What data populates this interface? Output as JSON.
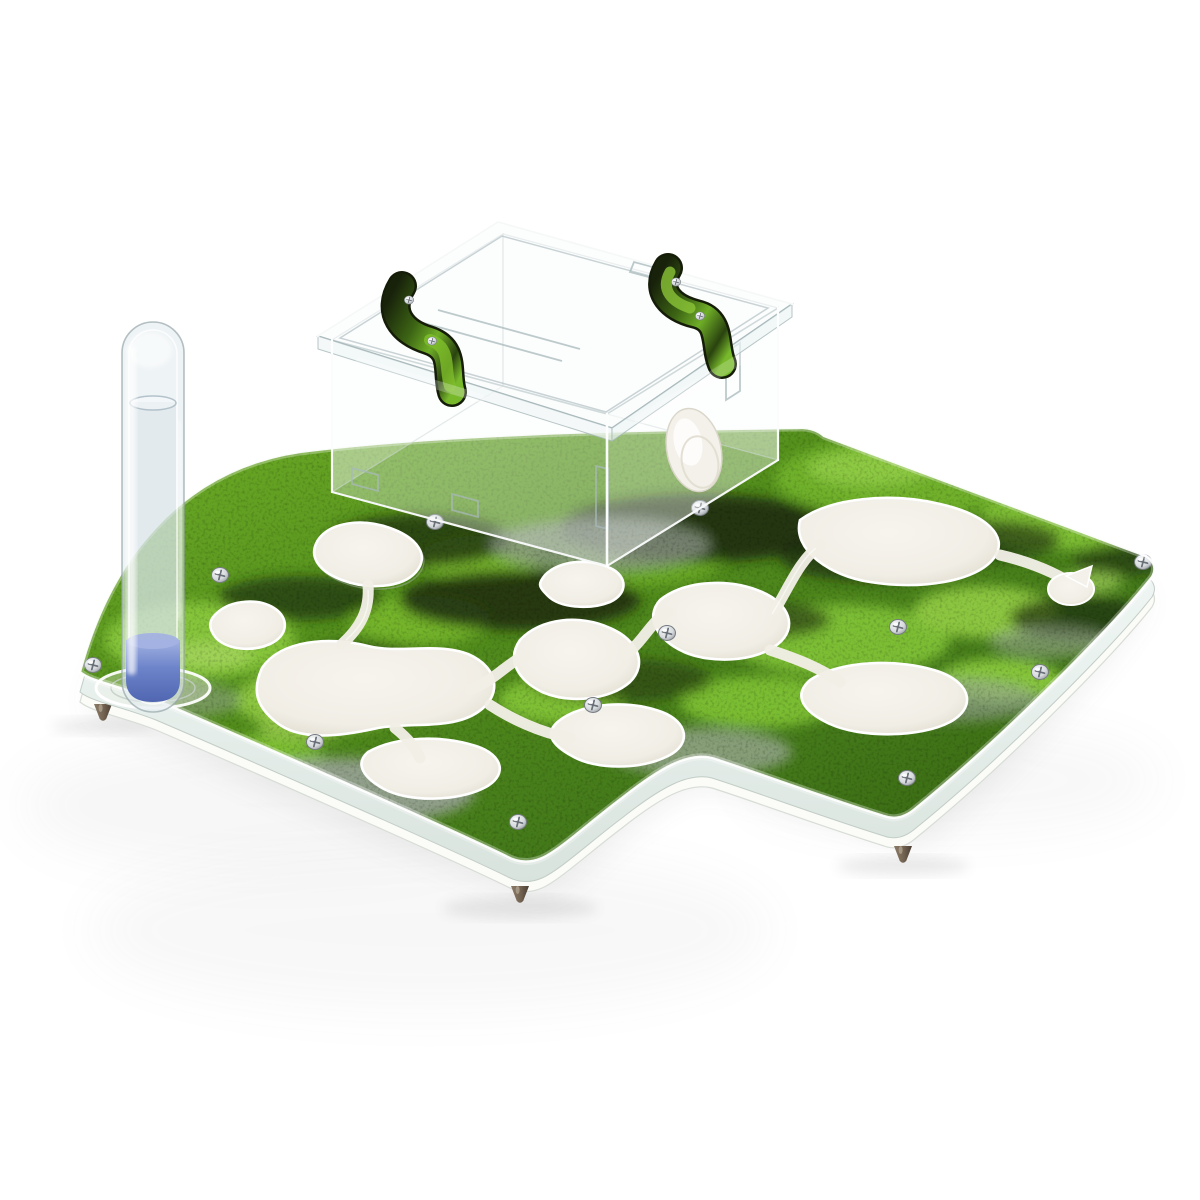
{
  "image": {
    "type": "product-photo",
    "subject": "Clear acrylic ant farm formicarium with green moss print, test tube and outworld box",
    "background": "white seamless studio backdrop"
  },
  "scene": {
    "parts": [
      "layered acrylic base plate with wavy front edge",
      "green moss-print top layer with organic nest-chamber cutouts",
      "white sandwich bottom layer",
      "phillips screws fastening the layers",
      "metal cone feet",
      "vertical glass test tube with water and blue cotton plug seated in a round port",
      "transparent acrylic outworld box with lid",
      "two moss-print lid clips",
      "white round feeding-port plug on box side",
      "round nest entrance hole with pointer notch"
    ],
    "counts": {
      "screws": 12,
      "nest_chambers": 10,
      "tunnel_channels": 8,
      "lid_clips": 2,
      "feet": 3,
      "test_tubes": 1
    }
  },
  "colors": {
    "bg": "#ffffff",
    "moss-light": "#8cc63f",
    "moss-mid": "#55911d",
    "moss-dark": "#2c4013",
    "stone-gray": "#9aa49a",
    "chamber-white": "#f1eee6",
    "chamber-shade": "#dcd7c8",
    "acrylic-edge": "#ffffff",
    "acrylic-tint": "#eaf2ef",
    "acrylic-line": "#a7b8ba",
    "tube-blue": "#6d84ca",
    "tube-blue-light": "#a3b2e2",
    "screw-silver": "#d6dadd",
    "screw-dark": "#84898e",
    "foot-brown": "#756553",
    "plug-white": "#f3f1ea"
  }
}
